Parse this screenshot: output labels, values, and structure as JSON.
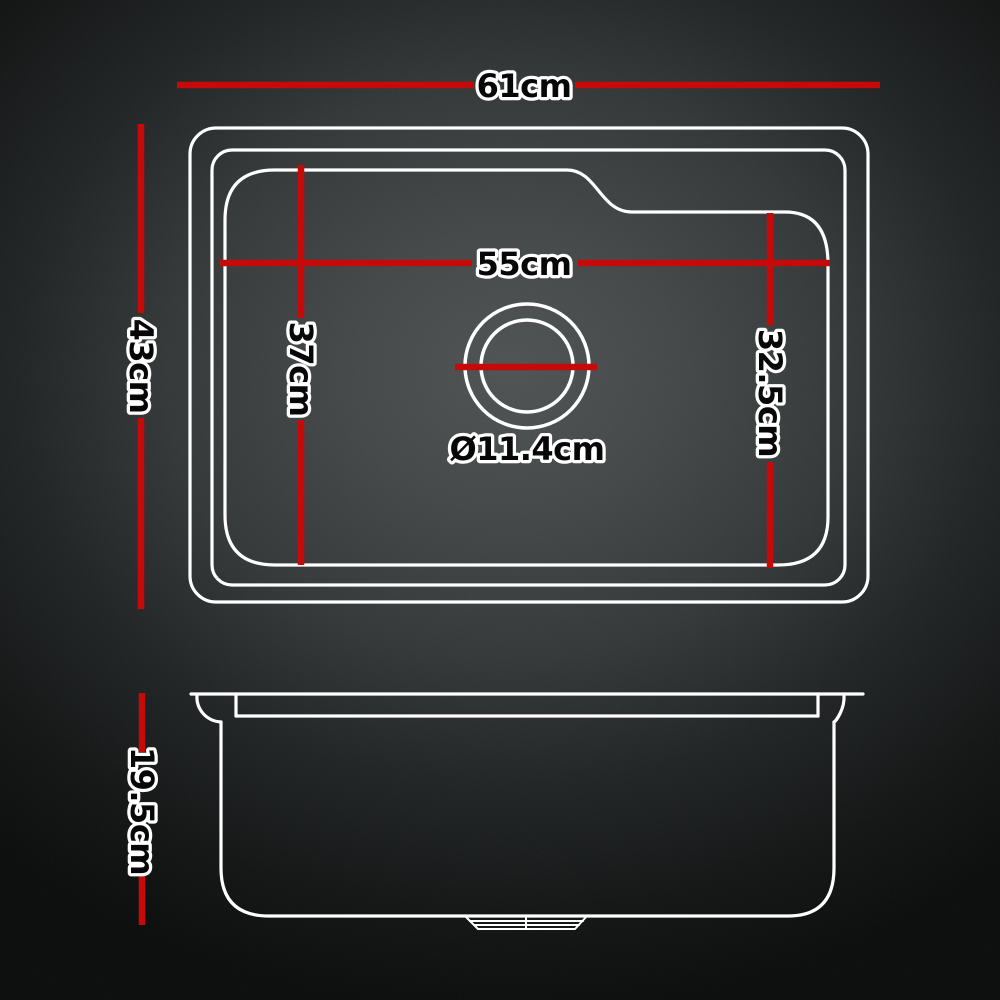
{
  "diagram": {
    "type": "product-dimension-diagram",
    "subject": "kitchen sink dimensions, top view and side view",
    "colors": {
      "dimension_line_red": "#c60a0a",
      "outline_white": "#ffffff",
      "label_fill": "#070707",
      "label_outline": "#ffffff",
      "background_center": "#4e5253",
      "background_edge": "#0a0b0b"
    },
    "top_view": {
      "overall_width": {
        "label": "61cm"
      },
      "overall_depth": {
        "label": "43cm"
      },
      "bowl_width": {
        "label": "55cm"
      },
      "bowl_depth": {
        "label": "37cm"
      },
      "bowl_right_depth": {
        "label": "32.5cm"
      },
      "drain_diameter": {
        "label": "Ø11.4cm"
      }
    },
    "side_view": {
      "bowl_height": {
        "label": "19.5cm"
      }
    }
  }
}
